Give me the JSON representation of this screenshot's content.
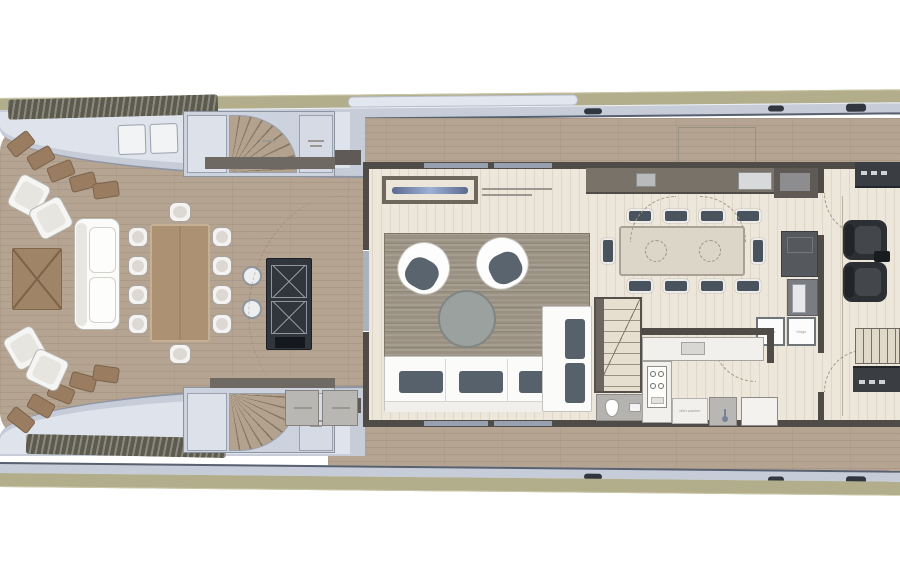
{
  "plan": {
    "type": "yacht-main-deck-floor-plan",
    "labels": {
      "fridge_left": "fridge",
      "fridge_right": "fridge",
      "dishwasher": "dish washer"
    },
    "palette": {
      "hull_khaki": "#b2ae8c",
      "superstructure": "#c6cdd9",
      "superstructure_light": "#dfe3ec",
      "rail_dark": "#596070",
      "deck_wood": "#b5a492",
      "interior_floor": "#ede6da",
      "wall_dark": "#4f4b46",
      "rug": "#9a9182",
      "sofa_white": "#fbfbfa",
      "cushion_slate": "#57616c",
      "coffee_table": "#9aa19e",
      "aft_table_wood": "#ad9173",
      "bar_dark": "#31363c",
      "chair_dark": "#49535d",
      "helm_seat": "#2c2f33",
      "counter_white": "#f2f0ec",
      "cushion_brown": "#9a7d61"
    }
  }
}
